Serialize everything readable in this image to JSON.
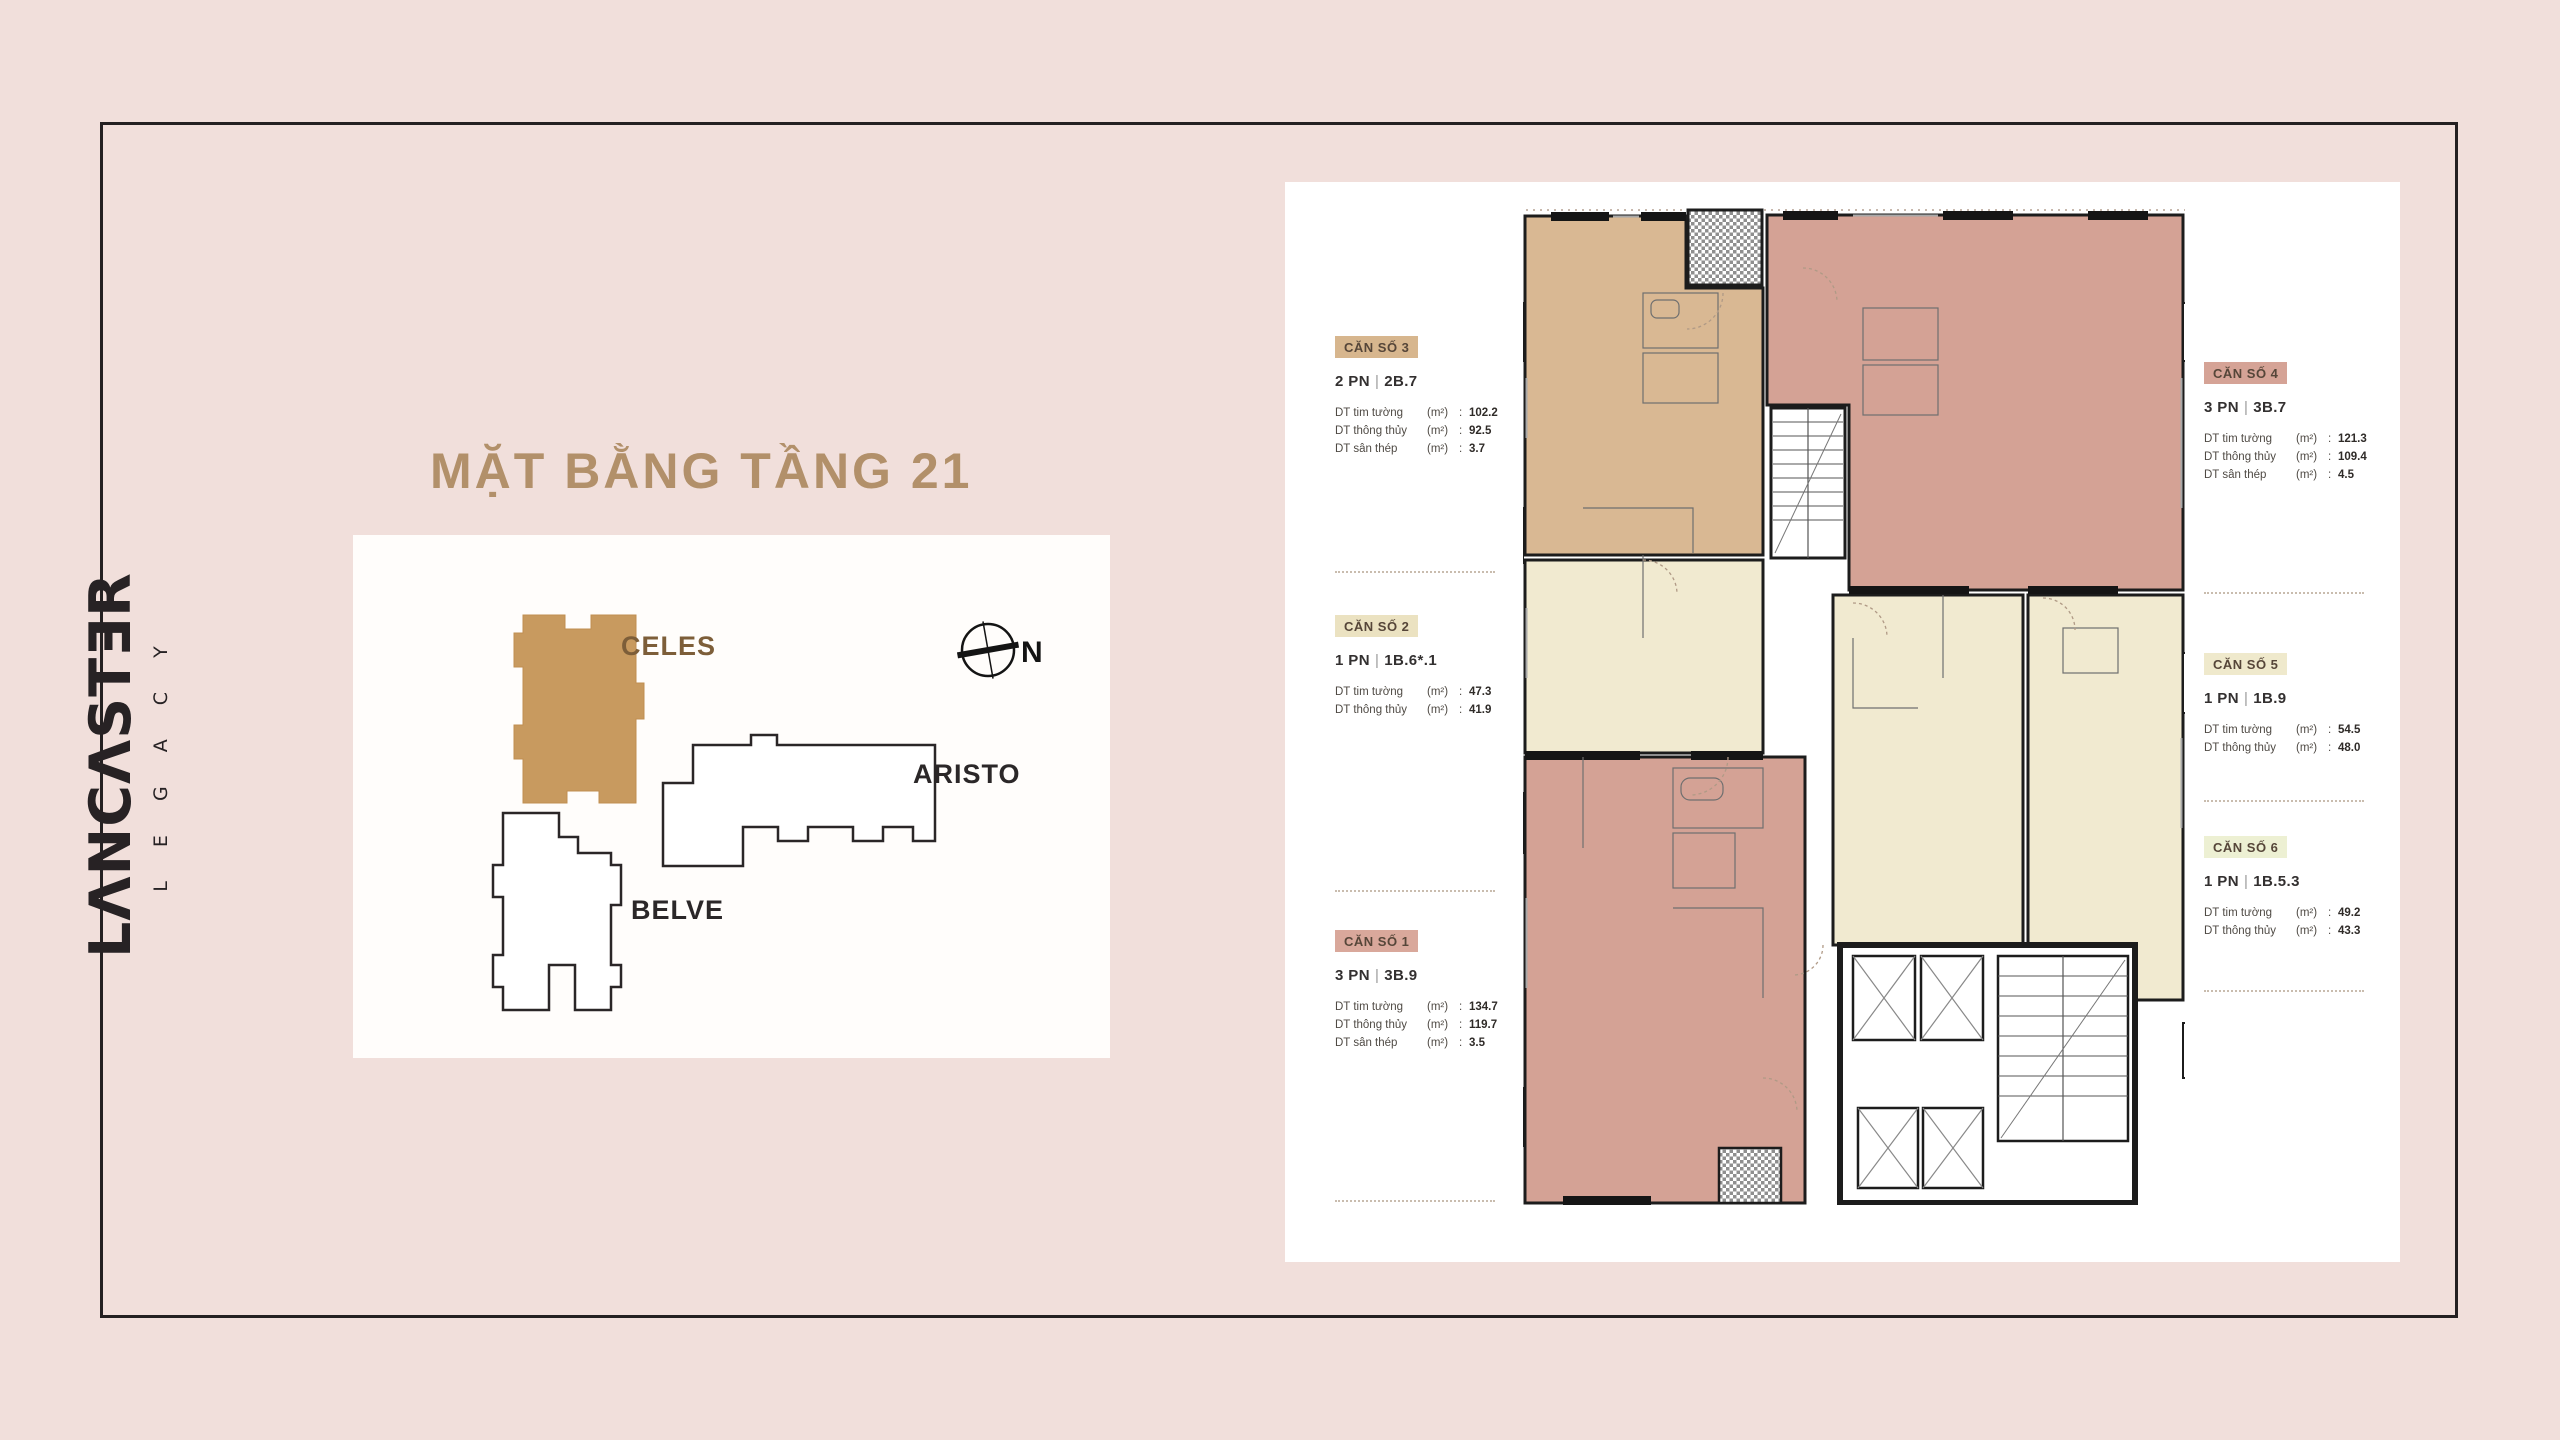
{
  "page": {
    "title": "MẶT BẰNG TẦNG 21",
    "background_color": "#f1dfdb",
    "frame_color": "#242021",
    "panel_color": "#ffffff",
    "title_color": "#b2906a"
  },
  "logo": {
    "brand": "LANCASTER",
    "brand_display": "LΛNCΛSTƎR",
    "subbrand": "LEGACY",
    "subbrand_display": "LEGACY",
    "color": "#272224"
  },
  "site_plan": {
    "compass_label": "N",
    "buildings": [
      {
        "name": "CELES",
        "highlighted": true,
        "fill": "#c89a5f",
        "label_color": "#7d5e39"
      },
      {
        "name": "ARISTO",
        "highlighted": false,
        "fill": "#ffffff",
        "label_color": "#2b2728"
      },
      {
        "name": "BELVE",
        "highlighted": false,
        "fill": "#ffffff",
        "label_color": "#2b2728"
      }
    ]
  },
  "floor_plan": {
    "colon": ":",
    "separator": "|",
    "colors": {
      "tan": "#d9b893",
      "mauve": "#d4a295",
      "cream": "#f1ead0",
      "wall": "#1c1c1c"
    },
    "units": [
      {
        "id": "can-so-3",
        "label": "CĂN SỐ 3",
        "bedrooms": "2 PN",
        "code": "2B.7",
        "chip_bg": "#d7b68e",
        "fill": "#d9b893",
        "stats": [
          {
            "name": "DT tim tường",
            "unit": "(m²)",
            "value": "102.2"
          },
          {
            "name": "DT thông thủy",
            "unit": "(m²)",
            "value": "92.5"
          },
          {
            "name": "DT sân thép",
            "unit": "(m²)",
            "value": "3.7"
          }
        ]
      },
      {
        "id": "can-so-2",
        "label": "CĂN SỐ 2",
        "bedrooms": "1 PN",
        "code": "1B.6*.1",
        "chip_bg": "#ebe2c1",
        "fill": "#f1ead0",
        "stats": [
          {
            "name": "DT tim tường",
            "unit": "(m²)",
            "value": "47.3"
          },
          {
            "name": "DT thông thủy",
            "unit": "(m²)",
            "value": "41.9"
          }
        ]
      },
      {
        "id": "can-so-1",
        "label": "CĂN SỐ 1",
        "bedrooms": "3 PN",
        "code": "3B.9",
        "chip_bg": "#d9a89b",
        "fill": "#d4a295",
        "stats": [
          {
            "name": "DT tim tường",
            "unit": "(m²)",
            "value": "134.7"
          },
          {
            "name": "DT thông thủy",
            "unit": "(m²)",
            "value": "119.7"
          },
          {
            "name": "DT sân thép",
            "unit": "(m²)",
            "value": "3.5"
          }
        ]
      },
      {
        "id": "can-so-4",
        "label": "CĂN SỐ 4",
        "bedrooms": "3 PN",
        "code": "3B.7",
        "chip_bg": "#d5a396",
        "fill": "#d4a295",
        "stats": [
          {
            "name": "DT tim tường",
            "unit": "(m²)",
            "value": "121.3"
          },
          {
            "name": "DT thông thủy",
            "unit": "(m²)",
            "value": "109.4"
          },
          {
            "name": "DT sân thép",
            "unit": "(m²)",
            "value": "4.5"
          }
        ]
      },
      {
        "id": "can-so-5",
        "label": "CĂN SỐ 5",
        "bedrooms": "1 PN",
        "code": "1B.9",
        "chip_bg": "#efe9cc",
        "fill": "#f1ead0",
        "stats": [
          {
            "name": "DT tim tường",
            "unit": "(m²)",
            "value": "54.5"
          },
          {
            "name": "DT thông thủy",
            "unit": "(m²)",
            "value": "48.0"
          }
        ]
      },
      {
        "id": "can-so-6",
        "label": "CĂN SỐ 6",
        "bedrooms": "1 PN",
        "code": "1B.5.3",
        "chip_bg": "#edf0d3",
        "fill": "#f1ead0",
        "stats": [
          {
            "name": "DT tim tường",
            "unit": "(m²)",
            "value": "49.2"
          },
          {
            "name": "DT thông thủy",
            "unit": "(m²)",
            "value": "43.3"
          }
        ]
      }
    ]
  }
}
